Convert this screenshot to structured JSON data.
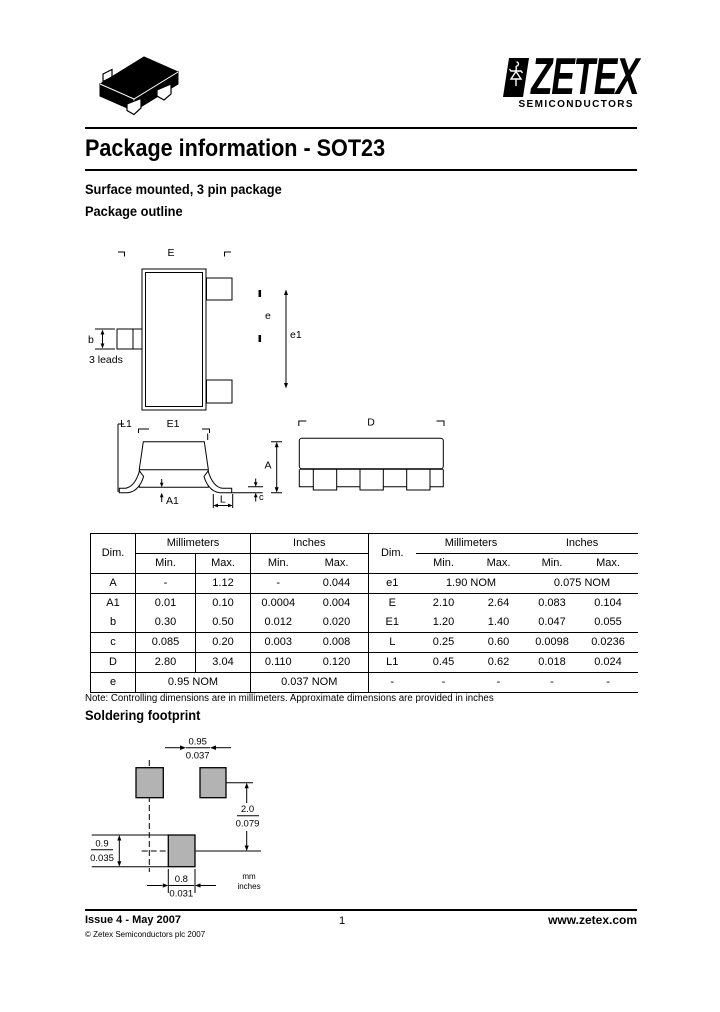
{
  "logo": {
    "brand": "ZETEX",
    "tagline": "SEMICONDUCTORS"
  },
  "page": {
    "title": "Package information - SOT23",
    "subtitle": "Surface mounted, 3 pin package",
    "outline_heading": "Package outline",
    "note": "Note: Controlling dimensions are in millimeters. Approximate dimensions are provided in inches",
    "footprint_heading": "Soldering footprint"
  },
  "outline_labels": {
    "e_overall": "E",
    "b": "b",
    "leads": "3 leads",
    "e_pitch": "e",
    "e1_span": "e1",
    "l1": "L1",
    "e1_body": "E1",
    "a": "A",
    "a1": "A1",
    "l": "L",
    "c": "c",
    "d": "D"
  },
  "dim_table": {
    "headers": {
      "dim": "Dim.",
      "millimeters": "Millimeters",
      "inches": "Inches",
      "min": "Min.",
      "max": "Max."
    },
    "left_rows": [
      [
        "A",
        "-",
        "1.12",
        "-",
        "0.044"
      ],
      [
        "A1",
        "0.01",
        "0.10",
        "0.0004",
        "0.004"
      ],
      [
        "b",
        "0.30",
        "0.50",
        "0.012",
        "0.020"
      ],
      [
        "c",
        "0.085",
        "0.20",
        "0.003",
        "0.008"
      ],
      [
        "D",
        "2.80",
        "3.04",
        "0.110",
        "0.120"
      ]
    ],
    "left_nom": {
      "dim": "e",
      "mm": "0.95 NOM",
      "inches": "0.037 NOM"
    },
    "right_nom": {
      "dim": "e1",
      "mm": "1.90 NOM",
      "inches": "0.075 NOM"
    },
    "right_rows": [
      [
        "E",
        "2.10",
        "2.64",
        "0.083",
        "0.104"
      ],
      [
        "E1",
        "1.20",
        "1.40",
        "0.047",
        "0.055"
      ],
      [
        "L",
        "0.25",
        "0.60",
        "0.0098",
        "0.0236"
      ],
      [
        "L1",
        "0.45",
        "0.62",
        "0.018",
        "0.024"
      ],
      [
        "-",
        "-",
        "-",
        "-",
        "-"
      ]
    ]
  },
  "footprint": {
    "pad_color": "#b3b3b3",
    "pitch_mm": "0.95",
    "pitch_in": "0.037",
    "height_mm": "2.0",
    "height_in": "0.079",
    "pad_h_mm": "0.9",
    "pad_h_in": "0.035",
    "pad_w_mm": "0.8",
    "pad_w_in": "0.031",
    "unit_mm": "mm",
    "unit_in": "inches"
  },
  "footer": {
    "issue": "Issue 4 - May 2007",
    "copyright": "© Zetex Semiconductors plc 2007",
    "page": "1",
    "website": "www.zetex.com"
  }
}
